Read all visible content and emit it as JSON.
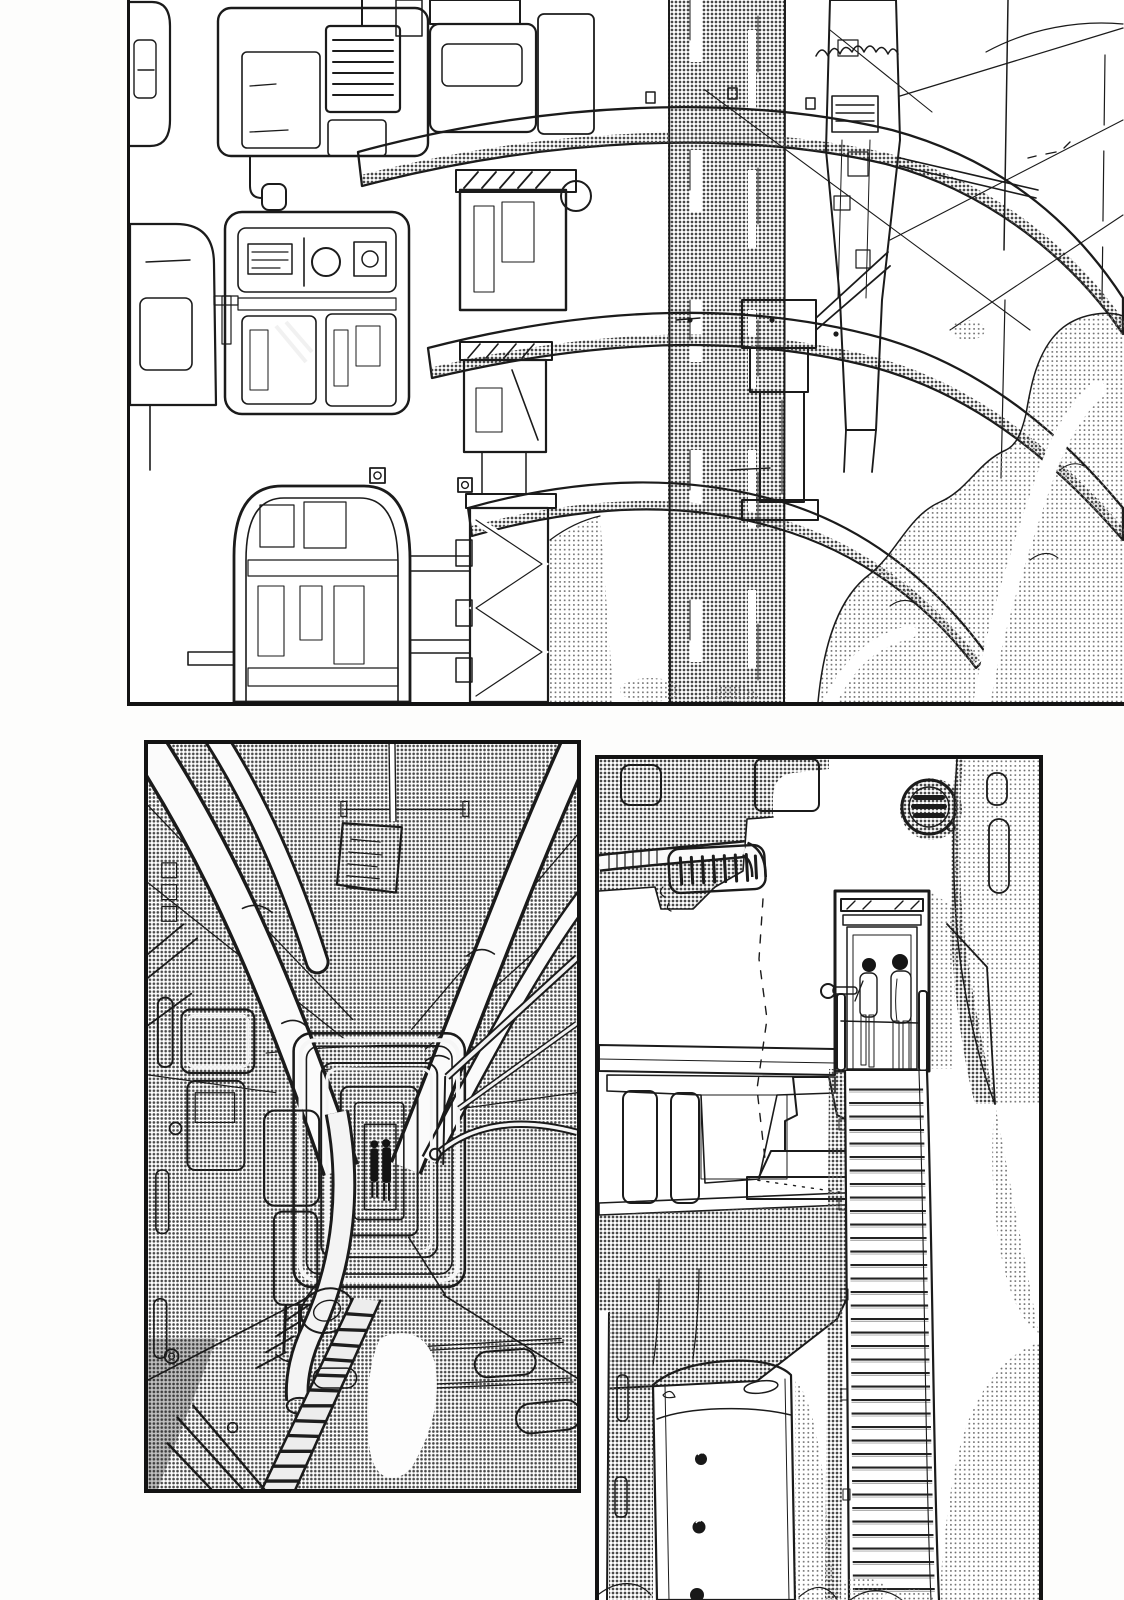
{
  "page": {
    "medium": "black-and-white manga page, ink linework with halftone screentone",
    "panel_count": 3,
    "colors": {
      "paper": "#ffffff",
      "ink": "#1b1b1b",
      "tone_mid": "#b5b5b5",
      "tone_light": "#dedede"
    }
  },
  "panels": [
    {
      "id": "panel-1",
      "position": "top, full width, cropped at top and right edges",
      "description": "Exterior of a massive industrial structure: blocky mechanical hatches and vents on the left, long curved structural beams sweeping to the right, a halftone-shaded central column, a lattice truss, a sketchy thin tower with cables, and banks of light screentone clouds below on the right."
    },
    {
      "id": "panel-2",
      "position": "bottom left",
      "description": "One-point-perspective interior corridor of a machine: large pipes converge overhead toward a nested rectangular doorway at the far end where two small dark silhouettes stand; equipment, handles and a curving pipe line the left wall; a ladder-like track runs across the floor toward the lower left corner; the whole scene is covered in medium halftone tone."
    },
    {
      "id": "panel-3",
      "position": "bottom right, tall, cropped at bottom edge",
      "description": "Exterior wall with a circular fan vent, a slotted grille and a corrugated pipe; two slender figures with dark heads stand in a shaded doorway at the top of a long narrow staircase that descends past machinery platforms and a riveted white tank into light screentone clouds."
    }
  ]
}
